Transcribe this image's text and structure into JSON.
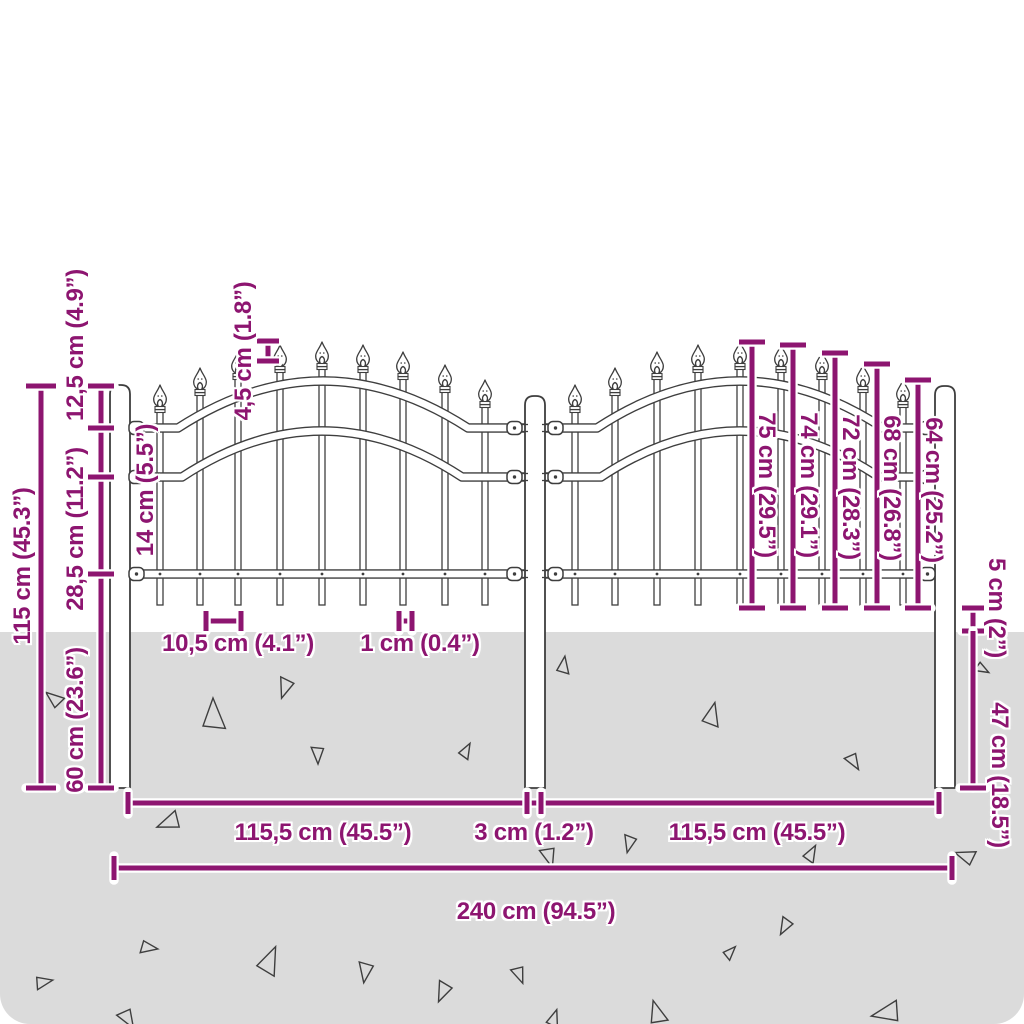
{
  "colors": {
    "dimension_accent": "#8d1570",
    "drawing_line": "#3e3e3e",
    "ground": "#dbdbdb",
    "background": "#ffffff"
  },
  "figure": {
    "type": "fence-dimension-diagram",
    "posts": 3,
    "panels": 2
  },
  "labels": {
    "height_total": "115 cm (45.3”)",
    "post_top_to_rail1": "12,5 cm (4.9”)",
    "rail1_to_rail2": "14 cm (5.5”)",
    "rail2_to_rail3": "28,5 cm (11.2”)",
    "post_buried_depth": "60 cm (23.6”)",
    "spear_height": "4,5 cm (1.8”)",
    "picket_spacing": "10,5 cm (4.1”)",
    "picket_width": "1 cm (0.4”)",
    "picket_height_1": "75 cm (29.5”)",
    "picket_height_2": "74 cm (29.1”)",
    "picket_height_3": "72 cm (28.3”)",
    "picket_height_4": "68 cm (26.8”)",
    "picket_height_5": "64 cm (25.2”)",
    "bottom_clearance": "5 cm (2”)",
    "buried_length_picket": "47 cm (18.5”)",
    "panel_width_left": "115,5 cm (45.5”)",
    "post_gap": "3 cm (1.2”)",
    "panel_width_right": "115,5 cm (45.5”)",
    "total_width": "240 cm (94.5”)"
  }
}
